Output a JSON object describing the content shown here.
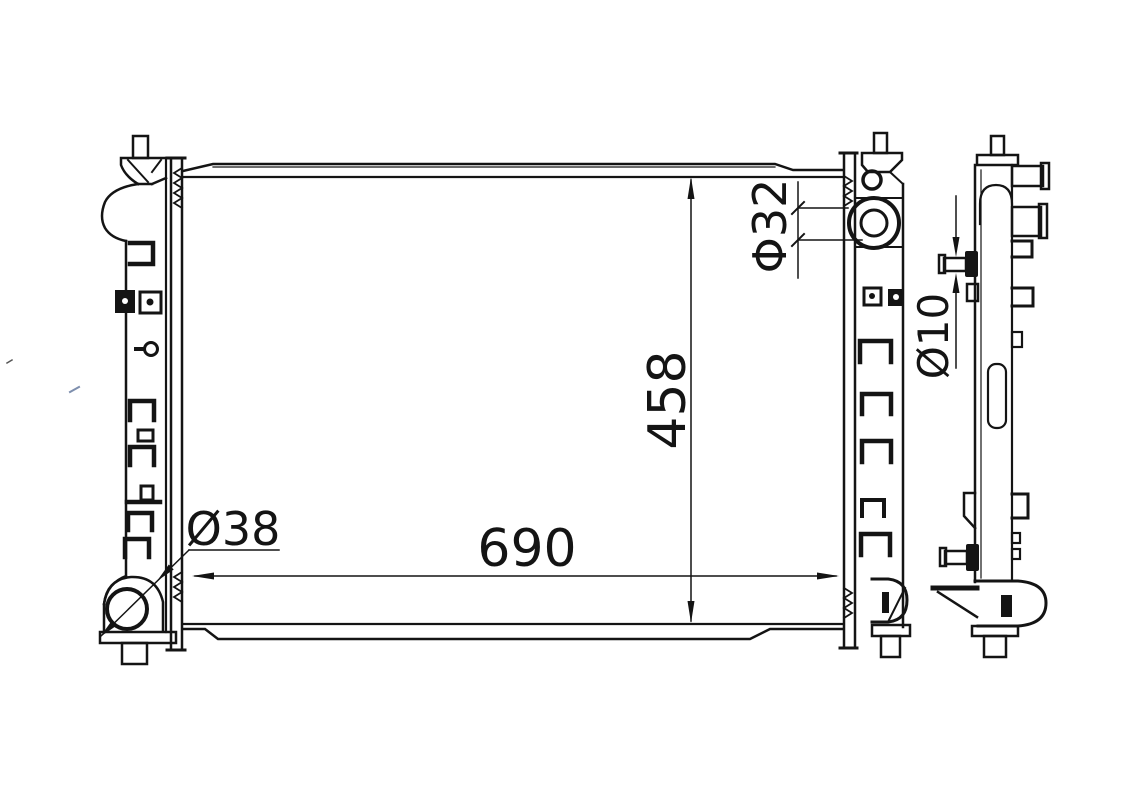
{
  "page": {
    "background_color": "#ffffff",
    "ink_color": "#141414"
  },
  "drawing": {
    "kind": "engineering-line-drawing",
    "subject": "automotive radiator, front elevation and side profile views",
    "views": [
      {
        "id": "front-view",
        "description": "radiator front elevation with filler neck (left tank), inlet pipe (right tank), mounting clips and outlet"
      },
      {
        "id": "side-view",
        "description": "narrow side profile with hose stubs, mounting pins and lower bracket"
      }
    ],
    "dimensions": {
      "core_width": {
        "label": "690",
        "value": 690,
        "orientation": "horizontal"
      },
      "core_height": {
        "label": "458",
        "value": 458,
        "orientation": "vertical-rotated"
      },
      "inlet_diameter": {
        "label": "Φ32",
        "value": 32,
        "orientation": "vertical-rotated"
      },
      "pin_diameter": {
        "label": "Ø10",
        "value": 10,
        "orientation": "vertical-rotated"
      },
      "outlet_diameter": {
        "label": "Ø38",
        "value": 38,
        "orientation": "horizontal"
      }
    }
  }
}
